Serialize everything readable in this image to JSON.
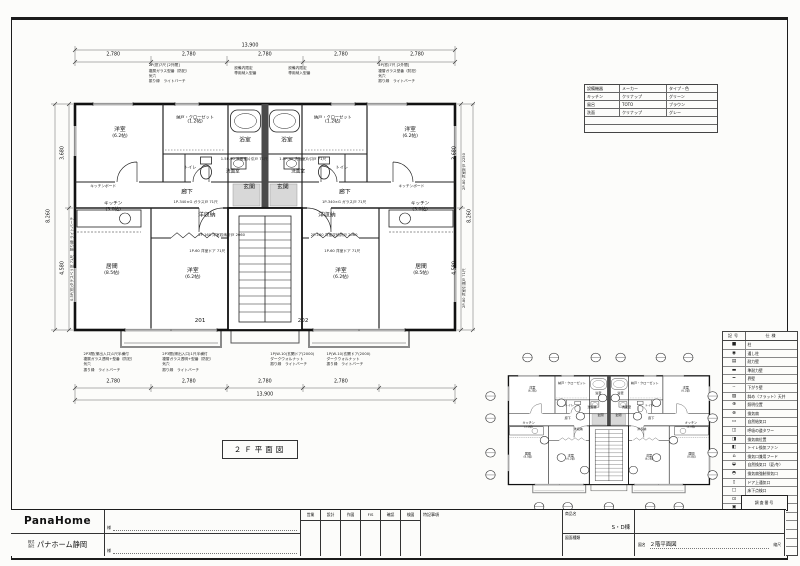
{
  "sheet": {
    "caption": "２Ｆ平面図"
  },
  "equipment_table": {
    "headers": [
      "設備機器",
      "メーカー",
      "タイプ・色"
    ],
    "rows": [
      [
        "キッチン",
        "クリナップ",
        "グリーン"
      ],
      [
        "風呂",
        "TOTO",
        "ブラウン"
      ],
      [
        "洗面",
        "クリナップ",
        "グレー"
      ]
    ]
  },
  "main_plan": {
    "unit_left": "201",
    "unit_right": "202",
    "dims": {
      "top_total": "13,900",
      "segment": "2,780",
      "bottom_total": "13,900",
      "left_upper": "3,680",
      "left_lower": "4,580",
      "side_total": "8,260"
    },
    "rooms": [
      {
        "label": "洋室",
        "size": "(6.2帖)"
      },
      {
        "label": "納戸・クローゼット",
        "size": "(1.2帖)"
      },
      {
        "label": "浴室",
        "size": ""
      },
      {
        "label": "浴室",
        "size": ""
      },
      {
        "label": "納戸・クローゼット",
        "size": "(1.2帖)"
      },
      {
        "label": "洋室",
        "size": "(6.2帖)"
      },
      {
        "label": "トイレ",
        "size": ""
      },
      {
        "label": "洗面室",
        "size": ""
      },
      {
        "label": "洗面室",
        "size": ""
      },
      {
        "label": "トイレ",
        "size": ""
      },
      {
        "label": "廊下",
        "size": ""
      },
      {
        "label": "玄関",
        "size": ""
      },
      {
        "label": "玄関",
        "size": ""
      },
      {
        "label": "廊下",
        "size": ""
      },
      {
        "label": "洋収納",
        "size": ""
      },
      {
        "label": "洋収納",
        "size": ""
      },
      {
        "label": "キッチン",
        "size": "(3.0帖)"
      },
      {
        "label": "キッチン",
        "size": "(3.0帖)"
      },
      {
        "label": "居間",
        "size": "(8.5帖)"
      },
      {
        "label": "居間",
        "size": "(8.5帖)"
      },
      {
        "label": "洋室",
        "size": "(6.2帖)"
      },
      {
        "label": "洋室",
        "size": "(6.2帖)"
      }
    ],
    "annotations": {
      "window_top": "2P(窓)7尺 [2外間]\n複層ガラス型番（防犯）\n気穴\n振り縁　ライトバーチ",
      "equip_note": "設備内限定\n専用納入型番",
      "window_bottom": "2P3間(掃出入口)1尺半横付\n複層ガラス透明+型番（防犯）\n気穴\n振り縁　ライトバーチ",
      "entry_door": "1P(W-10)玄関ドア(2000)\nダークウォルナット\n振り縁　ライトバーチ",
      "kitchen_board": "キッチンボード",
      "glass_door": "1P-340×G ガラス戸 71尺",
      "closet_door": "2P-160 洋室収納折戸 2060",
      "room_door": "1P-60 洋室ドア 71尺",
      "wash_door": "1.5P-90 洗面室片引戸 71尺",
      "side_door_1": "2P-80 洋室折戸 2250",
      "side_door_2": "2P-80 洋室引違戸 71尺",
      "side_window": "0.5P(窓)タテスベリ窓 71尺　振り縁 ライトバーチ"
    }
  },
  "legend": {
    "header_symbol": "記号",
    "header_spec": "仕様",
    "rows": [
      {
        "symbol": "■",
        "label": "柱"
      },
      {
        "symbol": "◉",
        "label": "通し柱"
      },
      {
        "symbol": "▤",
        "label": "耐力壁"
      },
      {
        "symbol": "▬",
        "label": "準耐力壁"
      },
      {
        "symbol": "━",
        "label": "界壁"
      },
      {
        "symbol": "╌",
        "label": "下がり壁"
      },
      {
        "symbol": "▨",
        "label": "斜め（フラット）天井"
      },
      {
        "symbol": "⊕",
        "label": "照明位置"
      },
      {
        "symbol": "⊗",
        "label": "換気扇"
      },
      {
        "symbol": "▭",
        "label": "自然給気口"
      },
      {
        "symbol": "◫",
        "label": "呼吸の道タワー"
      },
      {
        "symbol": "◨",
        "label": "換気扇位置"
      },
      {
        "symbol": "◧",
        "label": "トイレ換気ファン"
      },
      {
        "symbol": "⌂",
        "label": "換気口兼用フード"
      },
      {
        "symbol": "◒",
        "label": "自然換気口（夏/冬）"
      },
      {
        "symbol": "◓",
        "label": "換気扇強制排気口"
      },
      {
        "symbol": "▯",
        "label": "ドア上通気口"
      },
      {
        "symbol": "□",
        "label": "床下点検口"
      },
      {
        "symbol": "⊡",
        "label": "天井点検口"
      },
      {
        "symbol": "▣",
        "label": "照明器具位置"
      },
      {
        "symbol": "⊞",
        "label": "物干金物位置"
      },
      {
        "symbol": "A.C",
        "label": "エアコン位置"
      },
      {
        "symbol": "┄",
        "label": "カーテンレール"
      }
    ]
  },
  "title_block": {
    "logo": "PanaHome",
    "company_prefix": "株式会社",
    "company": "パナホーム静岡",
    "client_suffix": "様",
    "stamp_headers": [
      "営業",
      "設計",
      "作図",
      "FIS",
      "確認",
      "検図"
    ],
    "notes_label": "特記事項",
    "product_label": "商品名",
    "product_value": "S・D棟",
    "drawing_type_label": "図面種類",
    "name_label": "図名",
    "name_value": "２階平面図",
    "scale_label": "縮尺",
    "survey_label": "調査番号"
  }
}
